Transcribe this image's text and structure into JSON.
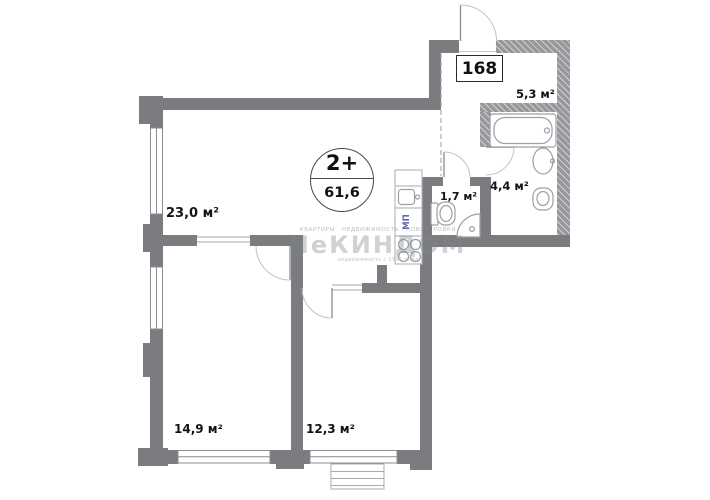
{
  "badge": {
    "type": "2+",
    "area": "61,6"
  },
  "apartment_number": "168",
  "rooms": {
    "living": {
      "label": "23,0 м²"
    },
    "hall": {
      "label": "5,3 м²"
    },
    "bath": {
      "label": "4,4 м²"
    },
    "wc": {
      "label": "1,7 м²"
    },
    "bedroom1": {
      "label": "14,9 м²"
    },
    "bedroom2": {
      "label": "12,3 м²"
    }
  },
  "kitchen": {
    "unit_label": "МП"
  },
  "watermark": {
    "line1": "КВАРТИРЫ  ·  НЕДВИЖИМОСТЬ  ·  НОВОСТРОЙКИ",
    "brand": "ЧеКИНДОМ",
    "line2": "недвижимость с 1991 года"
  },
  "colors": {
    "wall": "#7b7c7f",
    "wall_hatch": "#97989b",
    "fixture_line": "#9aa0a6",
    "label_text": "#141414",
    "mp_text": "#6066a8",
    "watermark": "#888d92"
  }
}
